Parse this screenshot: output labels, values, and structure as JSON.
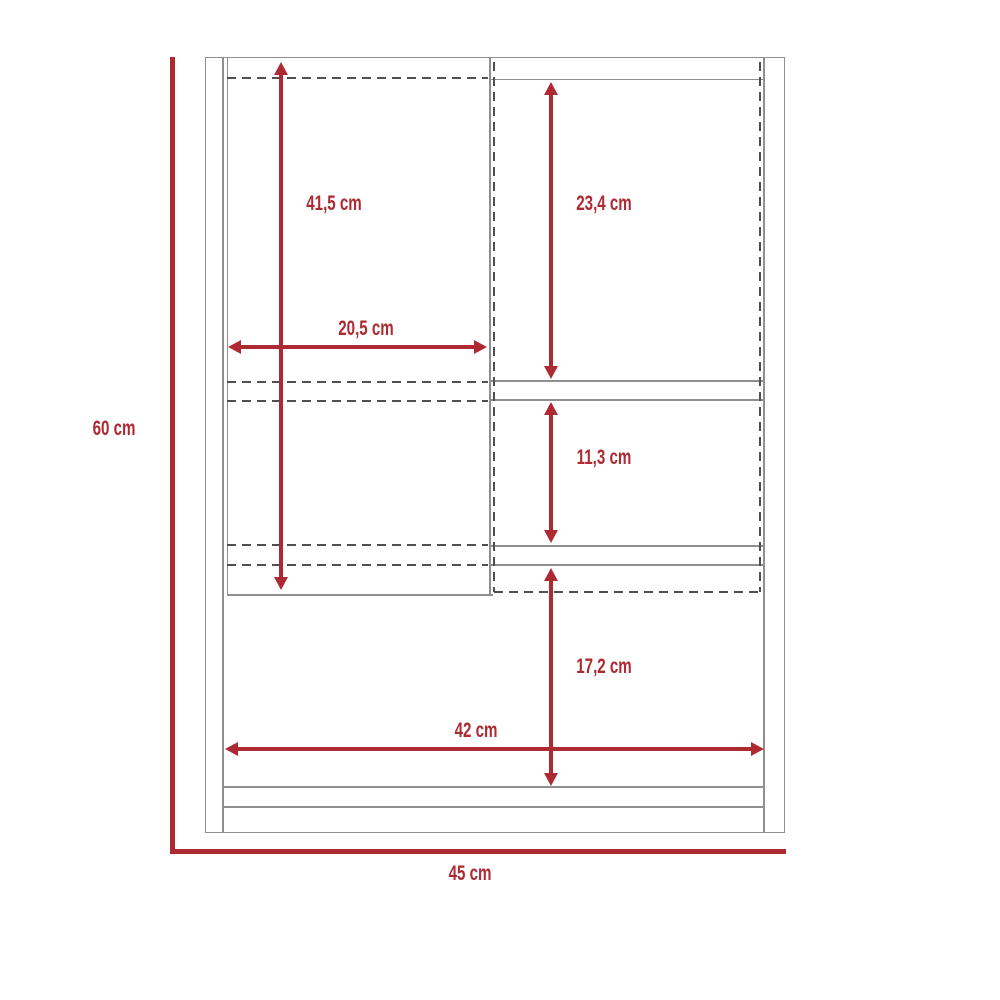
{
  "figure": {
    "type": "furniture-dimension-diagram",
    "subject": "wall-cabinet-front-view",
    "unit": "cm"
  },
  "colors": {
    "dimension_red": "#ad2a33",
    "cabinet_line_gray": "#8f8f8f",
    "hidden_line_dark": "#4f4f4f",
    "background": "#ffffff"
  },
  "dimensions": {
    "overall_height": "60 cm",
    "overall_width": "45 cm",
    "left_door_height": "41,5 cm",
    "left_door_width": "20,5 cm",
    "upper_right_compartment_height": "23,4 cm",
    "middle_right_compartment_height": "11,3 cm",
    "lower_compartment_height": "17,2 cm",
    "interior_width": "42 cm"
  }
}
